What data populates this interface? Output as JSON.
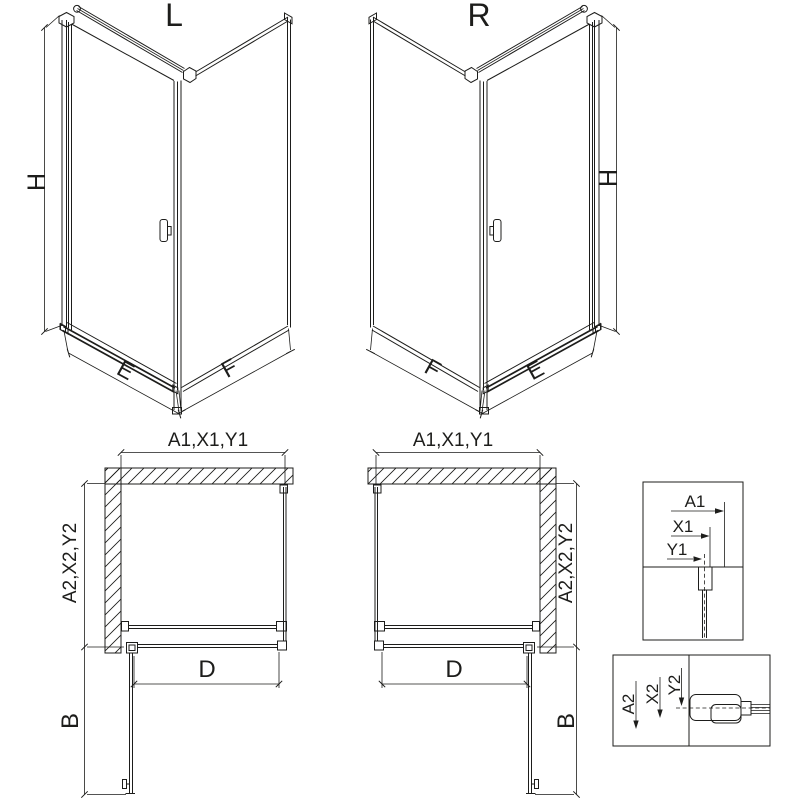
{
  "colors": {
    "line": "#1d1d1b",
    "background": "#ffffff"
  },
  "iso_views": [
    {
      "id": "left",
      "variant_label": "L",
      "height_dim": "H",
      "door_width_dim": "E",
      "side_panel_dim": "F"
    },
    {
      "id": "right",
      "variant_label": "R",
      "height_dim": "H",
      "door_width_dim": "E",
      "side_panel_dim": "F"
    }
  ],
  "plan_views": [
    {
      "id": "left",
      "width_dim": "A1,X1,Y1",
      "depth_dim": "A2,X2,Y2",
      "entry_dim": "D",
      "door_swing_dim": "B"
    },
    {
      "id": "right",
      "width_dim": "A1,X1,Y1",
      "depth_dim": "A2,X2,Y2",
      "entry_dim": "D",
      "door_swing_dim": "B"
    }
  ],
  "detail_views": [
    {
      "id": "top-profile",
      "dims": [
        "A1",
        "X1",
        "Y1"
      ]
    },
    {
      "id": "bottom-profile",
      "dims": [
        "A2",
        "X2",
        "Y2"
      ]
    }
  ]
}
